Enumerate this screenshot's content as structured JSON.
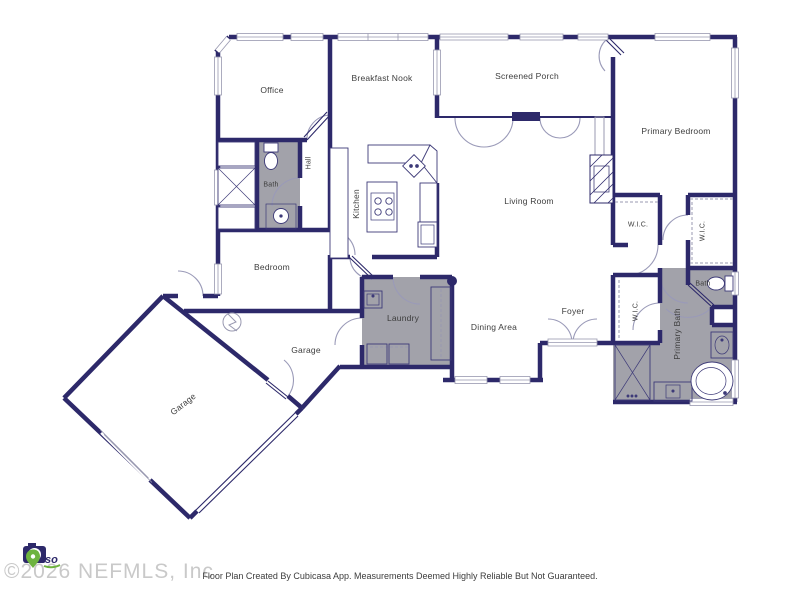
{
  "title": "Floor Plan",
  "rooms": {
    "office": {
      "label": "Office"
    },
    "breakfast_nook": {
      "label": "Breakfast Nook"
    },
    "screened_porch": {
      "label": "Screened Porch"
    },
    "primary_bedroom": {
      "label": "Primary Bedroom"
    },
    "hall": {
      "label": "Hall"
    },
    "bath": {
      "label": "Bath"
    },
    "kitchen": {
      "label": "Kitchen"
    },
    "living_room": {
      "label": "Living Room"
    },
    "wic_1": {
      "label": "W.I.C."
    },
    "wic_2": {
      "label": "W.I.C."
    },
    "wic_3": {
      "label": "W.I.C."
    },
    "bedroom": {
      "label": "Bedroom"
    },
    "laundry": {
      "label": "Laundry"
    },
    "dining_area": {
      "label": "Dining Area"
    },
    "foyer": {
      "label": "Foyer"
    },
    "bath_2": {
      "label": "Bath"
    },
    "primary_bath": {
      "label": "Primary Bath"
    },
    "garage_small": {
      "label": "Garage"
    },
    "garage_large": {
      "label": "Garage"
    }
  },
  "symbols": [
    "door-swing-icon",
    "window-icon",
    "garage-door-icon",
    "toilet-icon",
    "sink-icon",
    "bathtub-icon",
    "shower-icon",
    "cooktop-icon",
    "kitchen-island-icon",
    "washer-dryer-icon",
    "fireplace-icon",
    "electrical-icon",
    "closet-rod-icon"
  ],
  "colors": {
    "wall_navy": "#2d296a",
    "wet_room_gray": "#a2a2aa",
    "thin_line": "#9898b0",
    "label_text": "#3d3d3d",
    "watermark_gray": "#c9c9c9",
    "logo_green": "#6db33f",
    "footer_text": "#3c3c3c",
    "background": "#ffffff"
  },
  "watermark": {
    "text": "©2026 NEFMLS, Inc",
    "logo_text": "iso"
  },
  "footer": {
    "disclaimer": "Floor Plan Created By Cubicasa App. Measurements Deemed Highly Reliable But Not Guaranteed."
  }
}
